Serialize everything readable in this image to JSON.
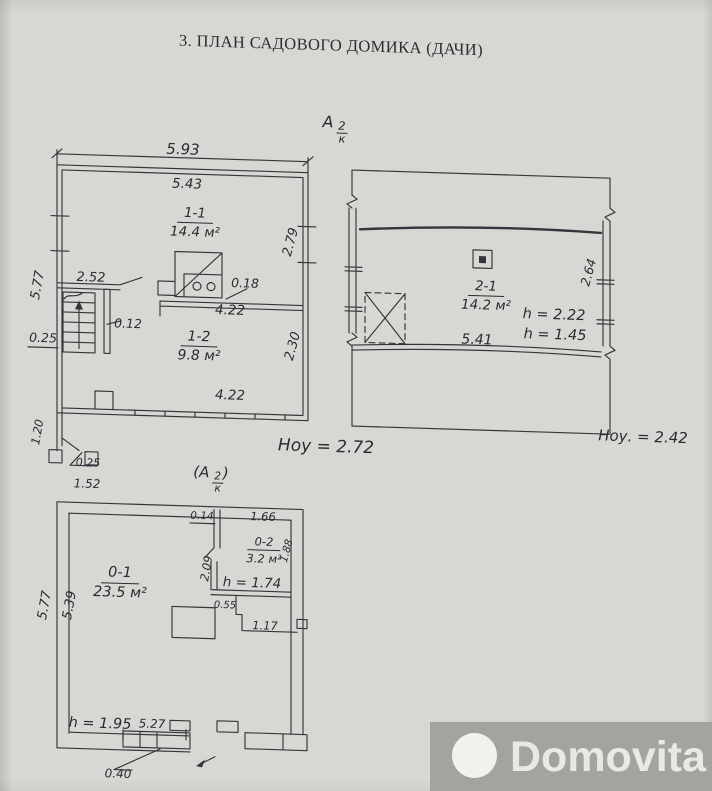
{
  "page": {
    "title": "3. ПЛАН САДОВОГО ДОМИКА (ДАЧИ)"
  },
  "colors": {
    "paper": "#d9d7d3",
    "ink": "#35353b",
    "pencil": "#2b2b33",
    "watermark_bg": "#a5a3a0",
    "watermark_text": "#e9e8e4"
  },
  "marks": {
    "upper": {
      "letter": "А",
      "num": "2",
      "den": "к"
    },
    "lower": {
      "prefix": "(",
      "letter": "А",
      "num": "2",
      "den": "к",
      "suffix": ")"
    }
  },
  "first_floor": {
    "dim_width_outer": "5.93",
    "dim_width_inner": "5.43",
    "room_living": {
      "id": "1-1",
      "area": "14.4 м²"
    },
    "dim_right_upper": "2.79",
    "dim_stairs_width": "2.52",
    "dim_stair_wall": "0.12",
    "dim_left_height": "5.77",
    "dim_left_offset": "0.25",
    "dim_stove_gap": "0.18",
    "dim_partition": "4.22",
    "room_kitchen": {
      "id": "1-2",
      "area": "9.8 м²"
    },
    "dim_right_lower": "2.30",
    "dim_bottom": "4.22",
    "dim_porch_height": "1.20",
    "dim_porch_step": "0.25",
    "dim_porch_width": "1.52",
    "height_note": "Hоу = 2.72"
  },
  "attic": {
    "room": {
      "id": "2-1",
      "area": "14.2 м²"
    },
    "h_ridge": "h = 2.22",
    "h_wall": "h = 1.45",
    "dim_bottom": "5.41",
    "dim_right": "2.64",
    "height_note": "Hоу. = 2.42"
  },
  "basement": {
    "dim_left_outer": "5.77",
    "dim_left_inner": "5.39",
    "dim_top_stub": "0.14",
    "dim_top_inner": "1.66",
    "room_main": {
      "id": "0-1",
      "area": "23.5 м²"
    },
    "room_small": {
      "id": "0-2",
      "area": "3.2 м²"
    },
    "dim_small_right": "1.88",
    "dim_partition_v": "2.09",
    "h_passage": "h = 1.74",
    "dim_step": "0.55",
    "dim_lower_passage": "1.17",
    "h_cellar": "h = 1.95",
    "dim_bottom_inner": "5.27",
    "dim_entry_step": "0.40"
  },
  "watermark": {
    "brand": "Domovita"
  }
}
